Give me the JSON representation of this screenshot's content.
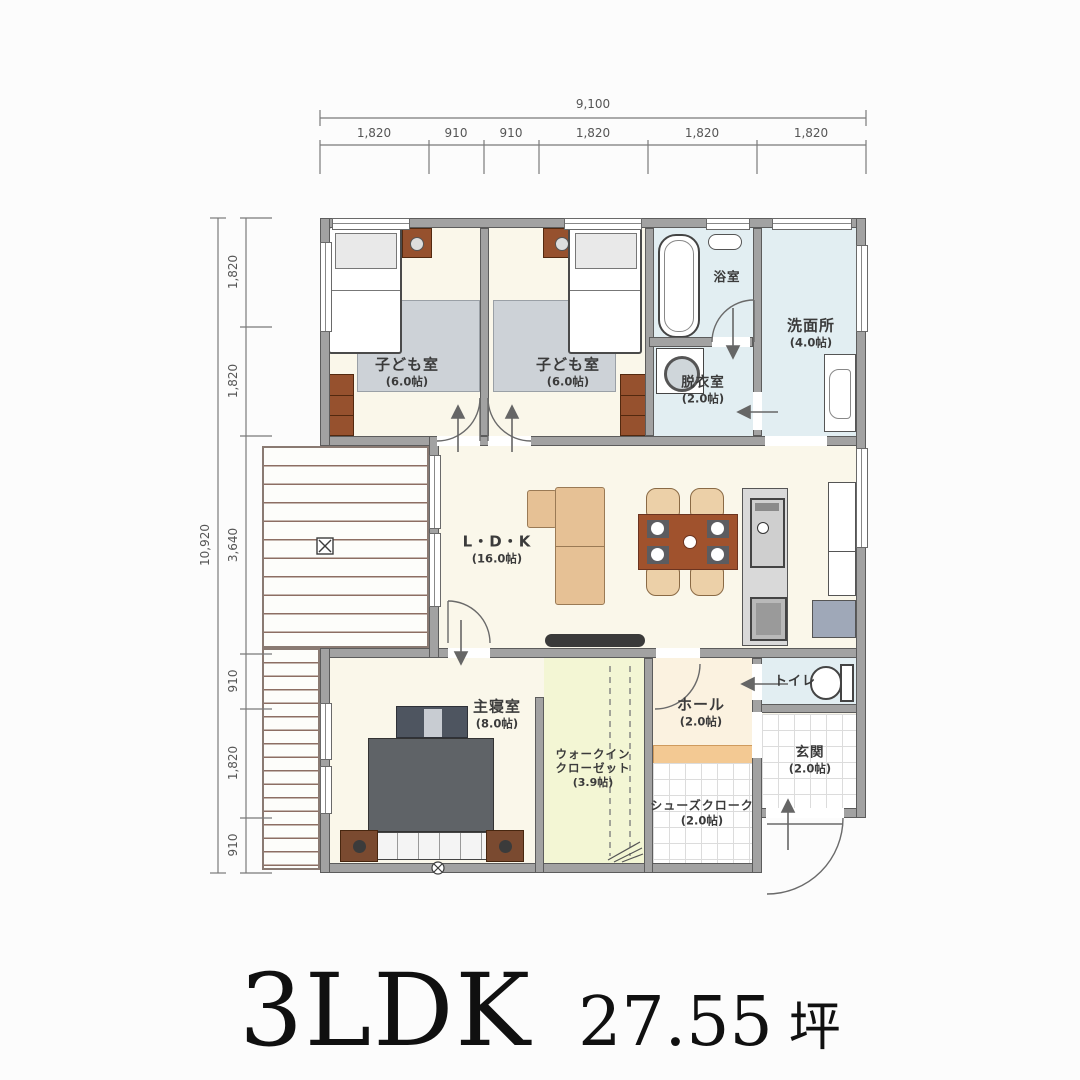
{
  "title": {
    "plan_type": "3LDK",
    "area": "27.55",
    "area_unit": "坪"
  },
  "dimensions": {
    "top": {
      "total": "9,100",
      "segments": [
        "1,820",
        "910",
        "910",
        "1,820",
        "1,820",
        "1,820"
      ]
    },
    "left": {
      "total": "10,920",
      "segments": [
        "1,820",
        "1,820",
        "3,640",
        "910",
        "1,820",
        "910"
      ]
    }
  },
  "rooms": {
    "kids_room_1": {
      "name": "子ども室",
      "size": "(6.0帖)"
    },
    "kids_room_2": {
      "name": "子ども室",
      "size": "(6.0帖)"
    },
    "bathroom": {
      "name": "浴室"
    },
    "washroom": {
      "name": "洗面所",
      "size": "(4.0帖)"
    },
    "dressing_room": {
      "name": "脱衣室",
      "size": "(2.0帖)"
    },
    "ldk": {
      "name": "L・D・K",
      "size": "(16.0帖)"
    },
    "master_bedroom": {
      "name": "主寝室",
      "size": "(8.0帖)"
    },
    "walk_in_closet": {
      "name_line1": "ウォークイン",
      "name_line2": "クローゼット",
      "size": "(3.9帖)"
    },
    "hall": {
      "name": "ホール",
      "size": "(2.0帖)"
    },
    "toilet": {
      "name": "トイレ"
    },
    "entrance": {
      "name": "玄関",
      "size": "(2.0帖)"
    },
    "shoe_closet": {
      "name": "シューズクローク",
      "size": "(2.0帖)"
    }
  },
  "colors": {
    "wall_gray": "#a2a2a2",
    "floor_cream": "#faf7ea",
    "water_blue": "#e2eef2",
    "wic_green": "#f3f6d4",
    "hall_beige": "#fbf2e0",
    "step_orange": "#f3c993",
    "table_brown": "#a0522d",
    "sofa_tan": "#e6c195",
    "deck_line_brown": "#8d6e63"
  }
}
